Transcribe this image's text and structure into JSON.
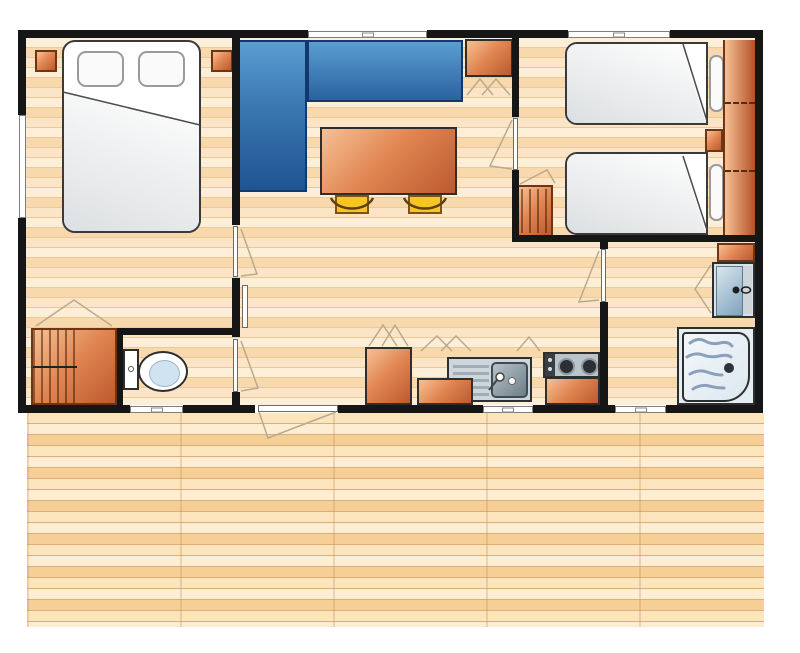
{
  "meta": {
    "type": "floor-plan",
    "description": "Mobile home chalet floor plan, top-down view, with wooden terrace deck"
  },
  "colors": {
    "wall": "#161616",
    "outline": "#2e2e2e",
    "wood_a": "#fdeed8",
    "wood_b": "#f8d9ae",
    "wood_c": "#fbe5c6",
    "wood_seam": "#ecc997",
    "deck_a": "#fce4bd",
    "deck_b": "#fdeed3",
    "deck_c": "#f6cf97",
    "deck_seam": "#dcae78",
    "orange_light": "#f7c094",
    "orange_mid": "#e08552",
    "orange_dark": "#bc5a2e",
    "orange_border": "#6e3413",
    "sofa_light": "#5a9ed1",
    "sofa_dark": "#1f5492",
    "sofa_border": "#14386b",
    "stool_yellow": "#f8c623",
    "stool_border": "#7d5512",
    "metal_light": "#cdd6db",
    "metal_mid": "#9fadb6",
    "metal_dark": "#6d7e88",
    "bed_white": "#ffffff",
    "bed_shadow": "#dcdfe1",
    "pillow_border": "#9a9a9a",
    "basin_light": "#d8e6ee",
    "basin_dark": "#7fa3bd",
    "wave": "#8aa0bc",
    "indicator": "#b9aa8d"
  },
  "rooms": [
    {
      "name": "bedroom-double",
      "furniture": [
        "double-bed",
        "pillow",
        "pillow",
        "nightstand",
        "nightstand",
        "hanging-wardrobe"
      ]
    },
    {
      "name": "living-dining",
      "furniture": [
        "corner-sofa",
        "dining-table",
        "stool",
        "stool",
        "cabinet"
      ]
    },
    {
      "name": "bedroom-twin",
      "furniture": [
        "single-bed",
        "single-bed",
        "pillow",
        "pillow",
        "nightstand",
        "wardrobe",
        "hanging-cabinet"
      ]
    },
    {
      "name": "wc",
      "furniture": [
        "toilet"
      ]
    },
    {
      "name": "kitchen",
      "furniture": [
        "tall-cabinet",
        "counter",
        "sink-with-drainboard",
        "stove-two-burner",
        "counter"
      ]
    },
    {
      "name": "shower-room",
      "furniture": [
        "cabinet",
        "washbasin",
        "shower-tray"
      ]
    },
    {
      "name": "terrace",
      "furniture": []
    }
  ]
}
